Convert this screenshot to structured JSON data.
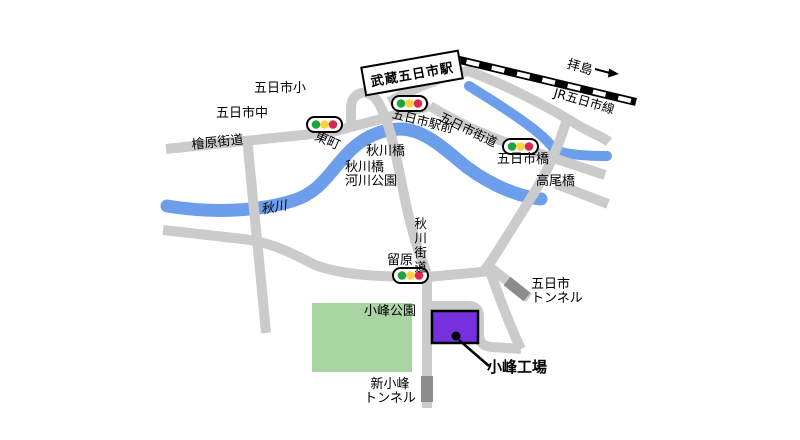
{
  "map_labels": {
    "station": "武蔵五日市駅",
    "rail_destination": "拝島",
    "rail_line": "JR五日市線",
    "elementary_school": "五日市小",
    "junior_high_school": "五日市中",
    "hinohara_kaido": "檜原街道",
    "azumacho": "東町",
    "itsukaichi_ekimae": "五日市駅前",
    "itsukaichi_kaido": "五日市街道",
    "itsukaichi_bashi": "五日市橋",
    "takao_bashi": "高尾橋",
    "akigawa_bashi": "秋川橋",
    "kasen_koen_line1": "秋川橋",
    "kasen_koen_line2": "河川公園",
    "akigawa_river": "秋川",
    "akigawa_kaido": "秋川街道",
    "tomehara": "留原",
    "itsukaichi_tunnel_line1": "五日市",
    "itsukaichi_tunnel_line2": "トンネル",
    "komine_park": "小峰公園",
    "shin_komine_tunnel_line1": "新小峰",
    "shin_komine_tunnel_line2": "トンネル",
    "komine_factory": "小峰工場"
  },
  "colors": {
    "road": "#cbcbcb",
    "river": "#6d9eeb",
    "railway": "#000000",
    "tunnel": "#8c8c8c",
    "park": "#a9d5a3",
    "factory": "#7531dd",
    "signal_green": "#1ea43c",
    "signal_yellow": "#fdd23e",
    "signal_red": "#dc2750"
  },
  "traffic_signal_locations": [
    "東町",
    "五日市駅前",
    "五日市橋",
    "留原"
  ]
}
